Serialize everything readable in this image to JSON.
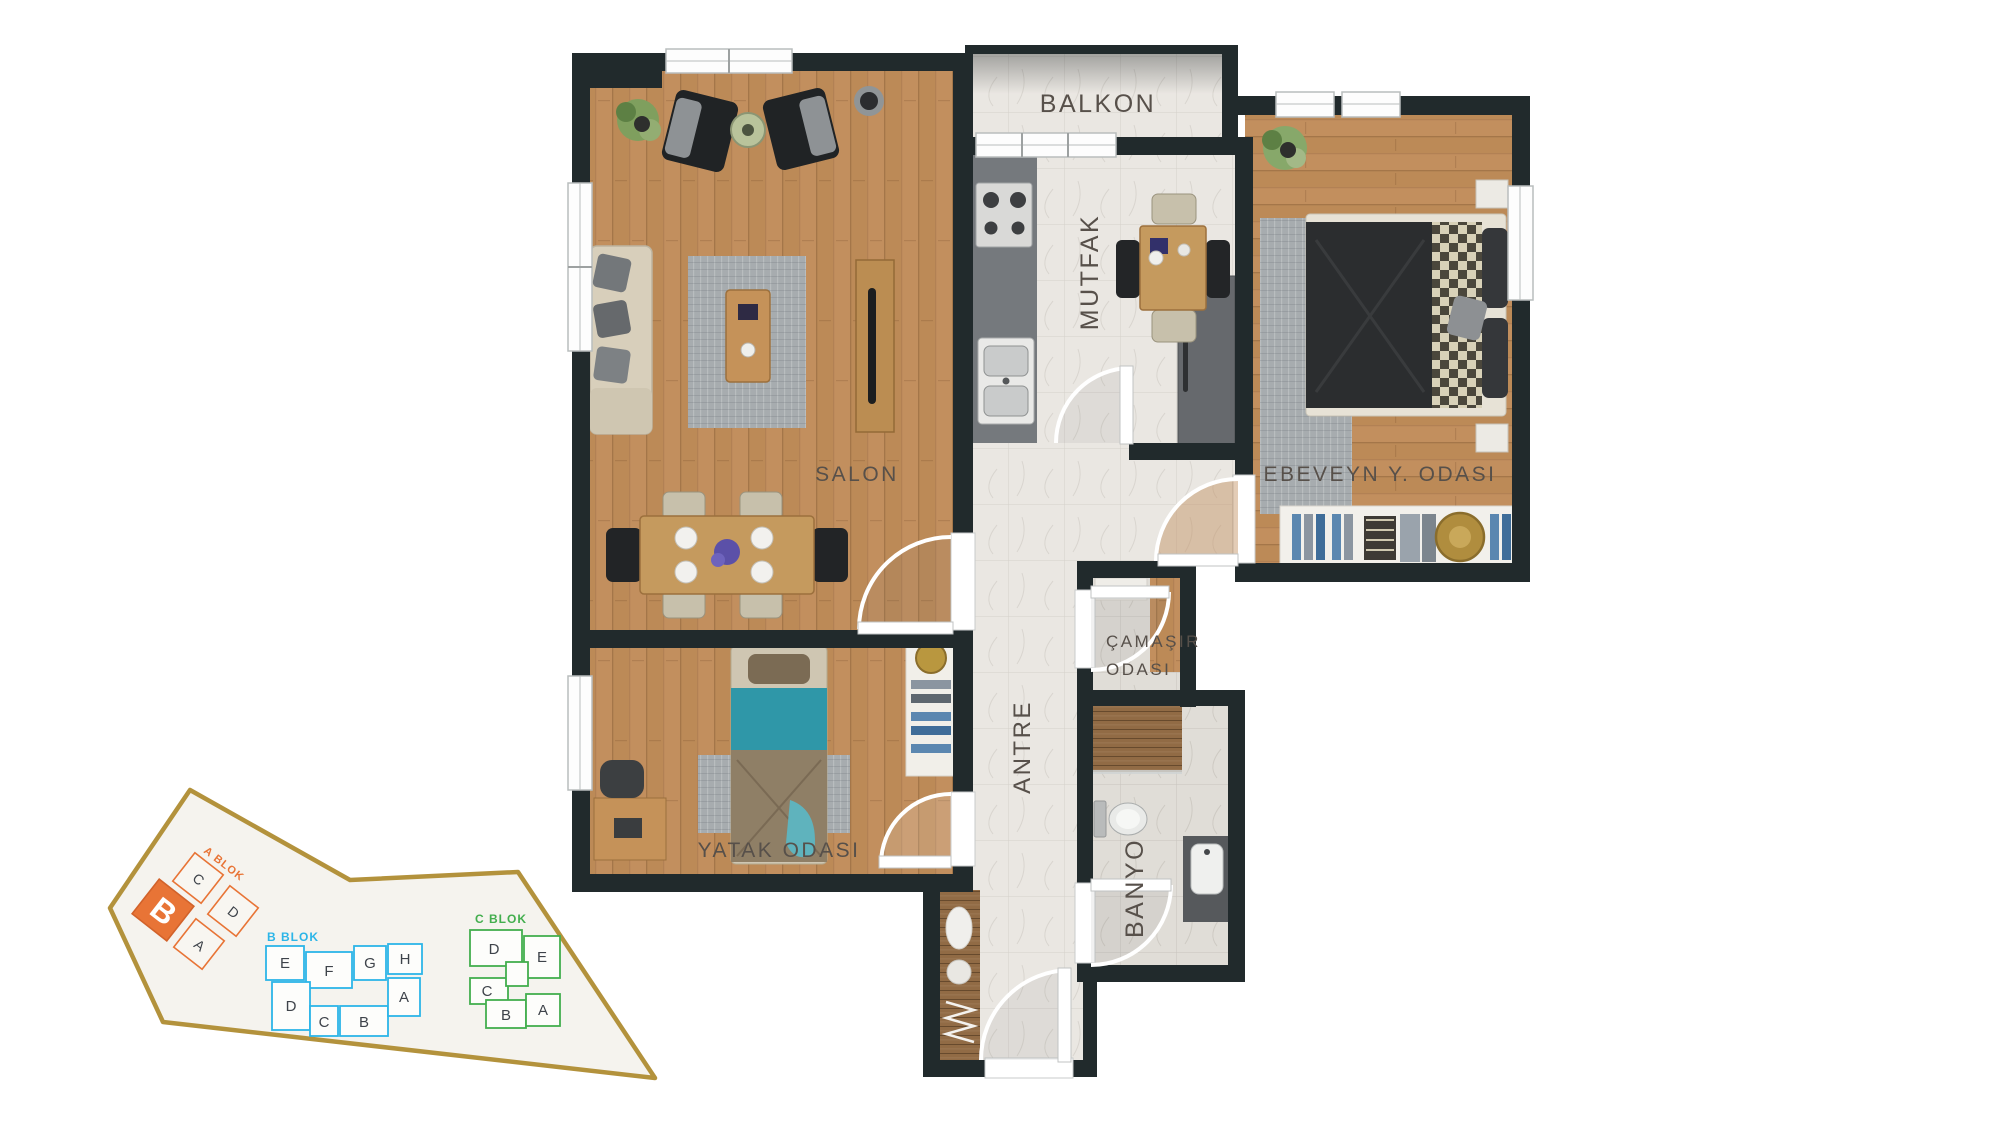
{
  "floor_plan": {
    "rooms": {
      "balkon": "BALKON",
      "mutfak": "MUTFAK",
      "salon": "SALON",
      "ebeveyn": "EBEVEYN Y. ODASI",
      "camasir_1": "ÇAMAŞIR",
      "camasir_2": "ODASI",
      "antre": "ANTRE",
      "yatak": "YATAK ODASI",
      "banyo": "BANYO"
    },
    "label_color": "#57504a",
    "wall_color": "#212a2c",
    "wood_color": "#c28f5e",
    "tile_color": "#eae7e2"
  },
  "site_plan": {
    "boundary_color": "#b3923c",
    "a_blok": {
      "label": "A BLOK",
      "color": "#e87436",
      "highlighted_unit": "B",
      "units": {
        "c": "C",
        "d": "D",
        "a": "A",
        "b": "B"
      }
    },
    "b_blok": {
      "label": "B BLOK",
      "color": "#2cb5e8",
      "units": {
        "e": "E",
        "f": "F",
        "g": "G",
        "h": "H",
        "d": "D",
        "c": "C",
        "b": "B",
        "a": "A"
      }
    },
    "c_blok": {
      "label": "C BLOK",
      "color": "#43ae4e",
      "units": {
        "d": "D",
        "e": "E",
        "c": "C",
        "b": "B",
        "a": "A"
      }
    }
  }
}
